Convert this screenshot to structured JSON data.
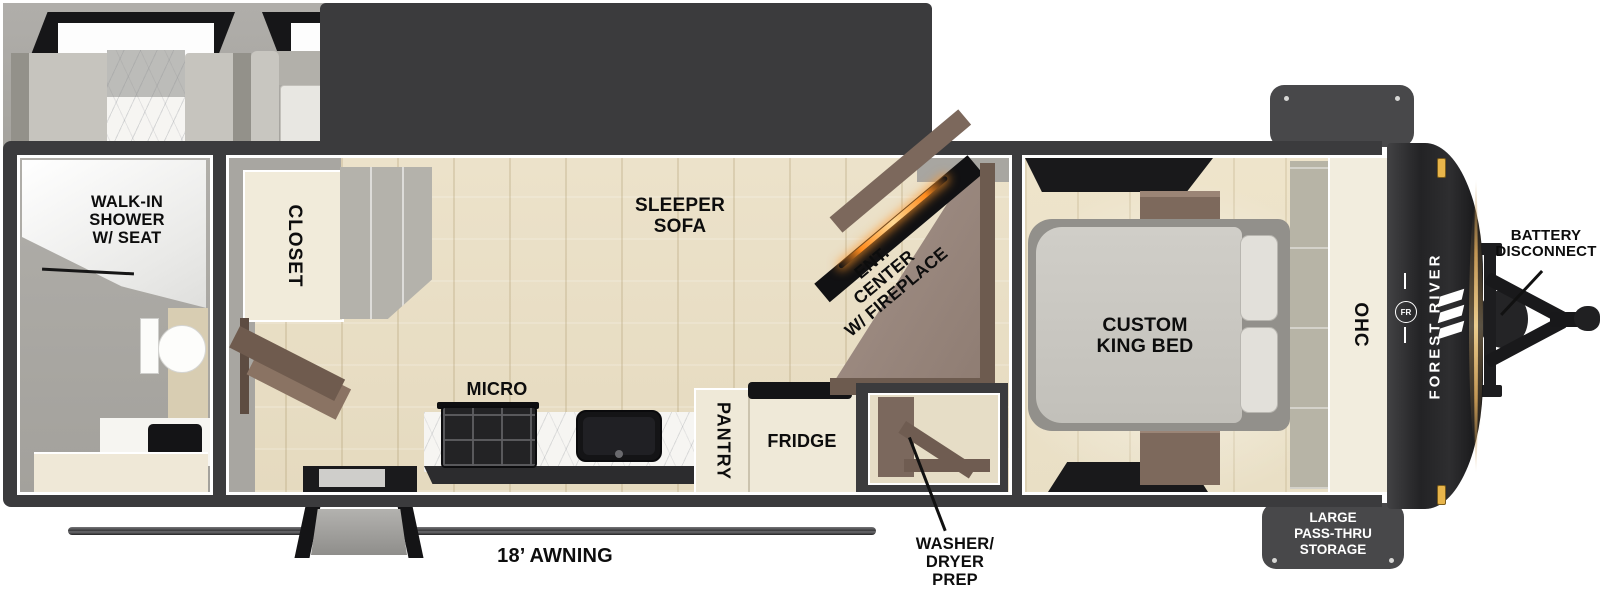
{
  "floorplan": {
    "rooms": {
      "bathroom_label": "WALK-IN\nSHOWER\nW/ SEAT",
      "closet_label": "CLOSET",
      "sofa_label": "SLEEPER\nSOFA",
      "ent_center_label": "ENT.\nCENTER\nW/ FIREPLACE",
      "micro_label": "MICRO",
      "pantry_label": "PANTRY",
      "fridge_label": "FRIDGE",
      "washer_label": "WASHER/\nDRYER\nPREP",
      "bed_label": "CUSTOM\nKING BED",
      "ohc_label": "OHC"
    },
    "exterior": {
      "awning_label": "18’ AWNING",
      "battery_label": "BATTERY\nDISCONNECT",
      "storage_label": "LARGE\nPASS-THRU\nSTORAGE",
      "brand_name": "FOREST RIVER",
      "brand_logo": "FR"
    },
    "colors": {
      "wall": "#3b3b3d",
      "floor_wood": "#e9dfc6",
      "interior_gray": "#a9a7a2",
      "cabinet_cream": "#f1ebda",
      "wood_brown": "#7c685c",
      "accent_gold": "#d9b06c",
      "fireplace_glow": "#ff9a2a",
      "label_text": "#0d0d0d"
    }
  }
}
